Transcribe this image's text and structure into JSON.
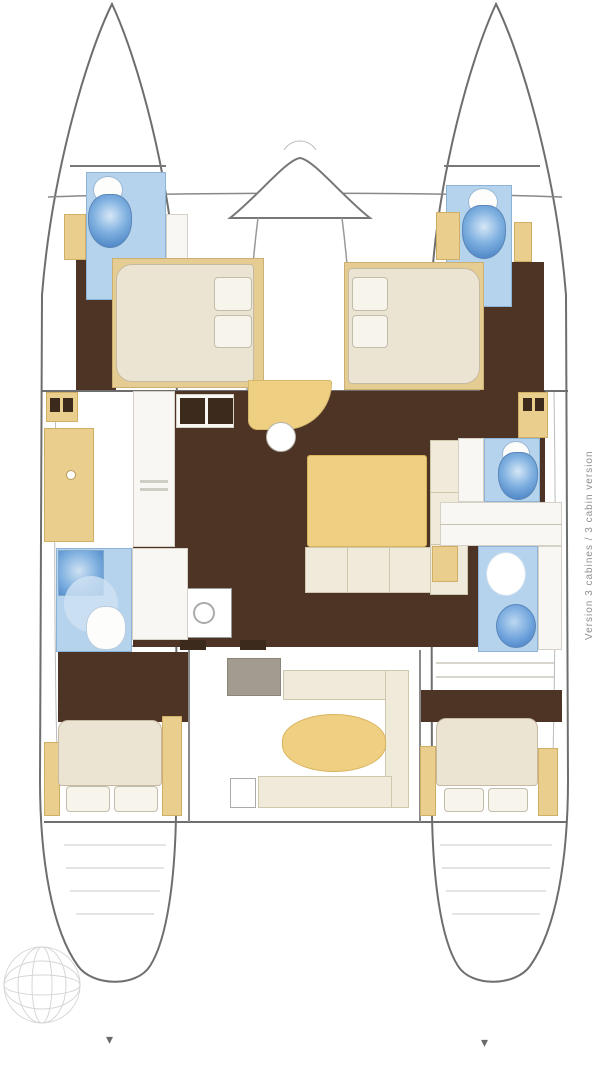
{
  "caption": {
    "text": "Version 3 cabines / 3 cabin version"
  },
  "icons": {
    "arrow_down": "▾",
    "compass_rose": "hatched-circle",
    "toilet": "toilet-plan-symbol",
    "sink": "round-basin-symbol",
    "shower": "shower-plan-symbol"
  },
  "palette": {
    "outline": "#6e6e6e",
    "floor-dark": "#4e3425",
    "floor-dark2": "#3c2a1c",
    "cream": "#ece4d2",
    "cream-border": "#c6bba2",
    "pillow": "#f7f4ec",
    "pillow-border": "#c2bcab",
    "sofa": "#f0eadb",
    "sofa-border": "#cfc6ae",
    "yellow": "#eace8e",
    "yellow-dark": "#d0ae66",
    "table-yellow": "#efcf81",
    "bath-blue": "#b5d3ec",
    "bath-blue-border": "#8db3d6",
    "fixture-blue": "#5b93d2",
    "fixture-blue-dark": "#3c77bc",
    "fixture-blue-light": "#d6e7f6",
    "white-counter": "#f8f7f3",
    "counter-border": "#d5d1c6",
    "grey-module": "#a29c90",
    "grey-module-border": "#8a8479",
    "step-grey": "#c9c9c9",
    "text-grey": "#8f8f8f",
    "line-soft": "#bbbbbb"
  }
}
